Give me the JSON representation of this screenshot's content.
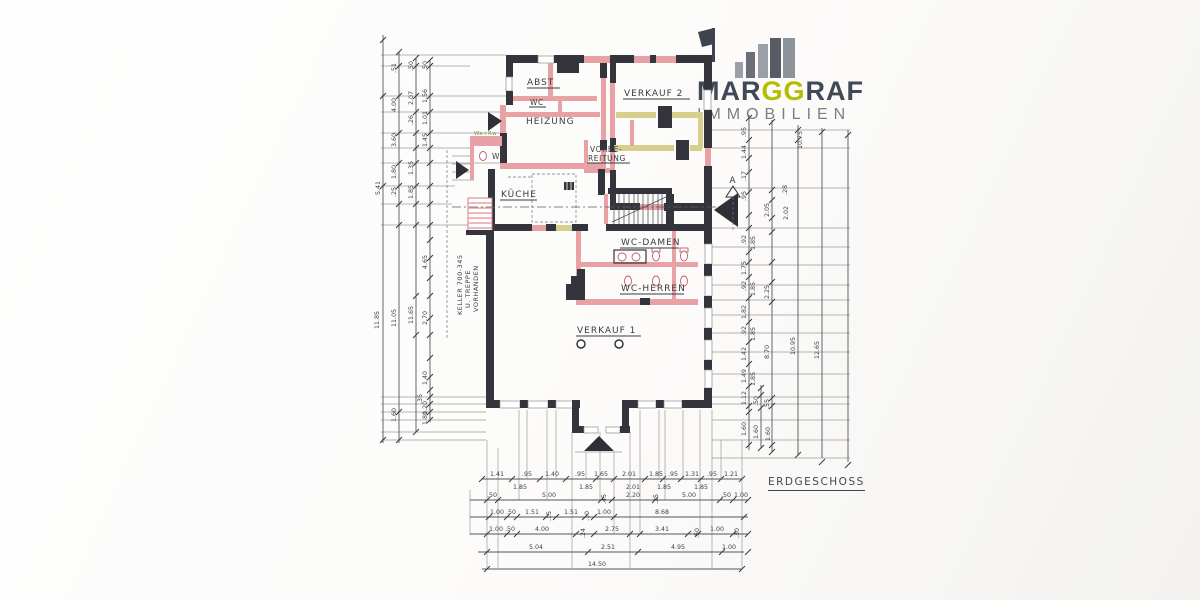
{
  "logo": {
    "word_pre": "MAR",
    "word_mid": "GG",
    "word_post": "RAF",
    "subtitle": "IMMOBILIEN"
  },
  "palette": {
    "accent": "#b5bd00",
    "logo_dark": "#414856",
    "logo_grey": "#7b8088",
    "wall_dark": "#34343d",
    "wall_pink": "#e8a2a5",
    "wall_yellow": "#d9cf8d"
  },
  "plan": {
    "floor_label": "ERDGESCHOSS",
    "section_letter": "A",
    "rooms": {
      "abst": "ABST",
      "wc_a": "WC",
      "wc_b": "WC",
      "heizung": "HEIZUNG",
      "verkauf2": "VERKAUF 2",
      "vorbe": "VORBE-",
      "reitung": "REITUNG",
      "kueche": "KÜCHE",
      "wc_damen": "WC-DAMEN",
      "wc_herren": "WC-HERREN",
      "verkauf1": "VERKAUF 1"
    },
    "notes": {
      "keller1": "KELLER 700-345",
      "keller2": "U. TREPPE",
      "keller3": "VORHANDEN",
      "green": "Wa+Rw"
    }
  },
  "dims": {
    "bottom_row1": [
      "1.41",
      ".95",
      "1.40",
      ".95",
      "1.65",
      "2.01",
      "1.85",
      ".95",
      "1.31",
      ".95",
      "1.21"
    ],
    "bottom_row1b": [
      "1.85",
      "1.85",
      "2.01",
      "1.85",
      "1.85"
    ],
    "bottom_row2": [
      ".50",
      "5.00",
      ".45",
      "2.20",
      ".25",
      "5.00",
      ".50",
      "1.00"
    ],
    "bottom_row3": [
      "1.00",
      ".50",
      "1.51",
      ".15",
      "1.51",
      ".10",
      "1.00",
      "8.68"
    ],
    "bottom_row4": [
      "1.00",
      ".50",
      "4.00",
      ".24",
      "2.75",
      "3.41",
      ".50",
      "1.00",
      ".30"
    ],
    "bottom_row5": [
      "5.04",
      "2.51",
      "4.95",
      "1.00"
    ],
    "bottom_row6": [
      "14.50"
    ],
    "left": [
      ".51",
      ".50",
      ".50",
      "4.00",
      "2.07",
      "1.56",
      ".26",
      "1.01",
      "3.60",
      "1.45",
      "1.80",
      "1.35",
      ".25",
      "1.85",
      "5.41",
      "4.65",
      "11.85",
      "11.05",
      "11.65",
      "2.70",
      "1.40",
      ".35",
      "1.20",
      "1.60",
      "1.80"
    ],
    "right": [
      ".95",
      "1.44",
      ".17",
      ".95",
      "10.75",
      ".28",
      "2.05",
      "2.02",
      ".92",
      "1.85",
      "1.75",
      ".92",
      "1.85",
      "2.25",
      "1.82",
      ".92",
      "1.85",
      "8.70",
      "10.95",
      "12.65",
      "1.42",
      "1.49",
      "1.85",
      "1.12",
      ".50",
      ".55",
      "1.60",
      "1.60",
      "1.60"
    ]
  }
}
